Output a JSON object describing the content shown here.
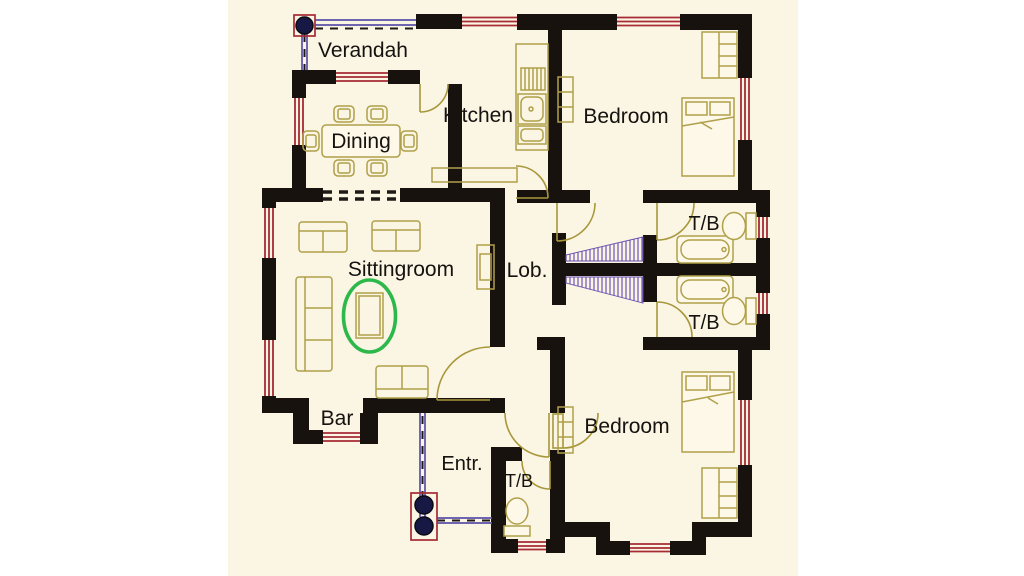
{
  "title": "House floor plan drawing",
  "rooms": {
    "verandah": "Verandah",
    "kitchen": "Kitchen",
    "bedroom_top": "Bedroom",
    "dining": "Dining",
    "sittingroom": "Sittingroom",
    "lobby": "Lob.",
    "tb_top": "T/B",
    "tb_bottom": "T/B",
    "bar": "Bar",
    "entrance": "Entr.",
    "tb_entrance": "T/B",
    "bedroom_bottom": "Bedroom"
  },
  "colors": {
    "wall": "#17120e",
    "window_red": "#a62b34",
    "porch_purple": "#5b4fa8",
    "stair_hatch_purple": "#7a5fc0",
    "furniture_khaki": "#b0a049",
    "door_arc": "#a8973a",
    "highlight_green": "#2db84b",
    "column_navy": "#181845",
    "plan_background": "#fbf5e4",
    "page_background": "#ffffff",
    "label_text": "#15120f"
  }
}
